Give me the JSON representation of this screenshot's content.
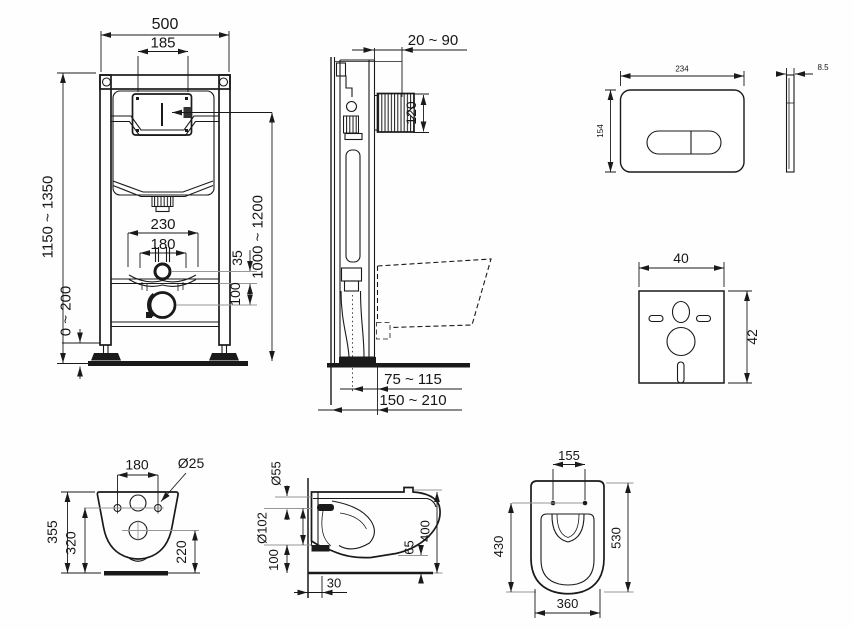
{
  "drawing_title": "Wall-hung WC installation frame and bowl dimensions",
  "views": {
    "frame_front": {
      "width": "500",
      "opening": "185",
      "height_range": "1150 ~ 1350",
      "flush_height_range": "1000 ~ 1200",
      "pipe_span": "230",
      "inner_span": "180",
      "offset_small": "35",
      "offset_drain": "100",
      "floor_range": "0 ~ 200"
    },
    "frame_side": {
      "wall_distance": "20 ~ 90",
      "bend_height": "120",
      "front_range": "75 ~ 115",
      "wall_range": "150 ~ 210"
    },
    "flush_plate": {
      "width": "234",
      "height": "154",
      "thickness": "8.5"
    },
    "insulation_mat": {
      "width": "40",
      "height": "42"
    },
    "bowl_rear": {
      "bolt_spacing": "180",
      "bolt_diameter": "Ø25",
      "height": "355",
      "mid_height": "320",
      "drain_height": "220"
    },
    "bowl_side": {
      "flush_diameter": "Ø55",
      "drain_diameter": "Ø102",
      "drain_center": "100",
      "height": "400",
      "clearance": "65",
      "offset": "30"
    },
    "bowl_top": {
      "hinge_spacing": "155",
      "inner_length": "430",
      "length": "530",
      "width": "360"
    }
  }
}
